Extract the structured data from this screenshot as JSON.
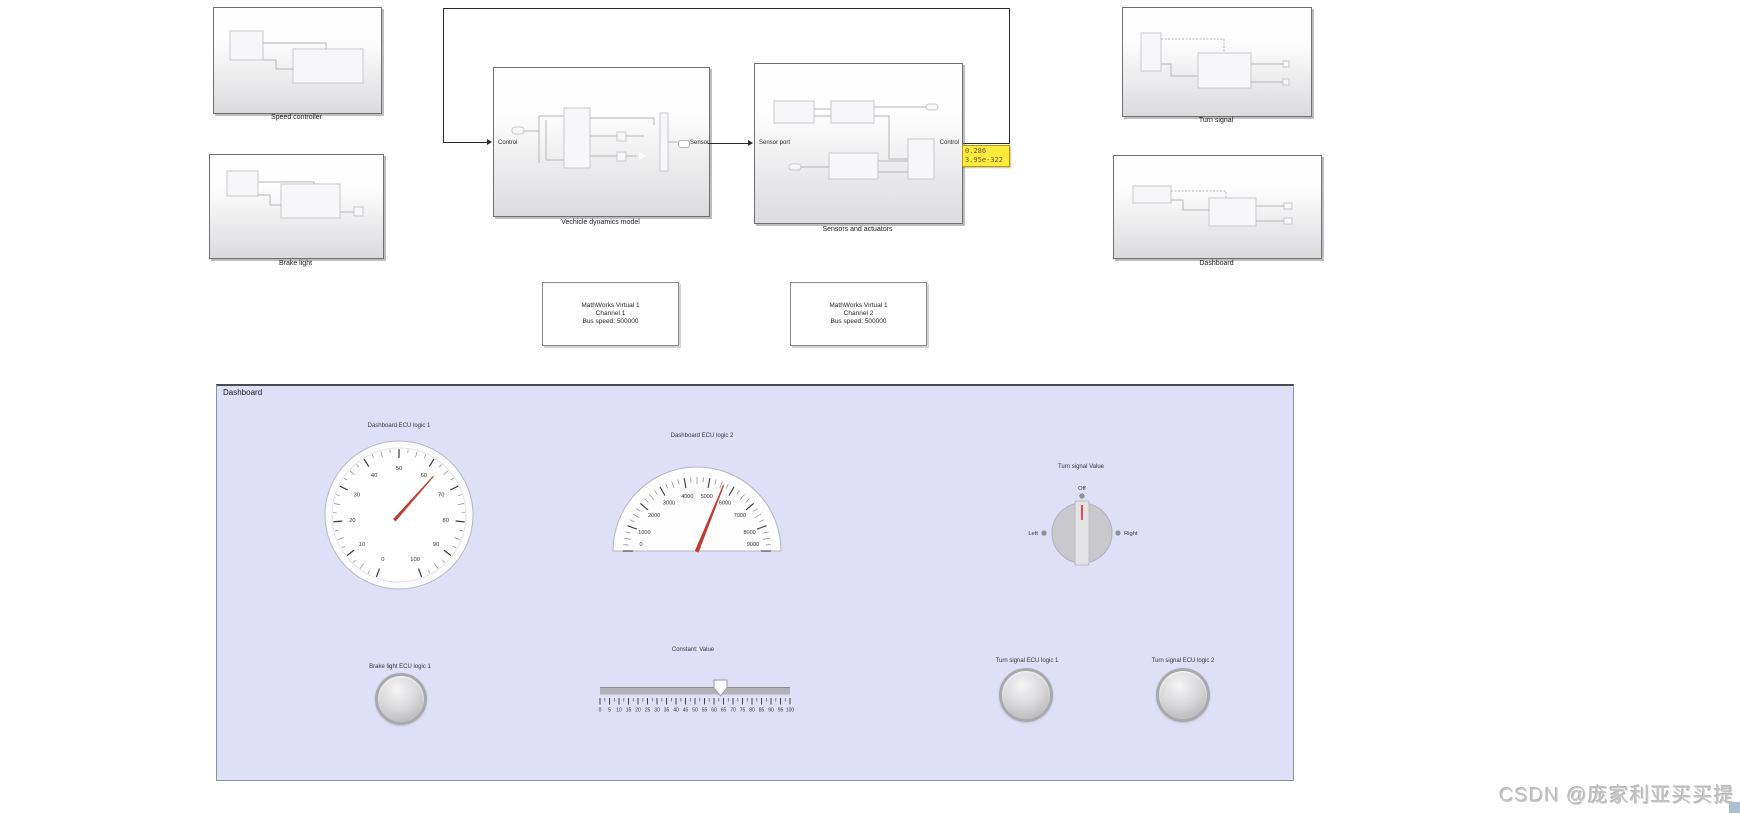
{
  "diagram": {
    "blocks": {
      "speed_controller": {
        "label": "Speed controller"
      },
      "brake_light": {
        "label": "Brake light"
      },
      "vehicle_dynamics": {
        "label": "Vechicle dynamics model",
        "port_in": "Control",
        "port_out": "Sensor"
      },
      "sensors_actuators": {
        "label": "Sensors and actuators",
        "port_in": "Sensor port",
        "port_out": "Control"
      },
      "turn_signal": {
        "label": "Turn signal"
      },
      "dashboard": {
        "label": "Dashboard"
      }
    },
    "can_blocks": [
      {
        "line1": "MathWorks Virtual 1",
        "line2": "Channel 1",
        "line3": "Bus speed: 500000"
      },
      {
        "line1": "MathWorks Virtual 1",
        "line2": "Channel 2",
        "line3": "Bus speed: 500000"
      }
    ],
    "port_value_tooltip": {
      "line1": "0.286",
      "line2": "3.95e-322"
    }
  },
  "panel": {
    "title": "Dashboard"
  },
  "chart_data": [
    {
      "type": "gauge",
      "variant": "circular",
      "title": "Dashboard ECU logic 1",
      "min": 0,
      "max": 100,
      "label_step": 10,
      "minor_step": 2.5,
      "value": 63,
      "start_angle": -160,
      "end_angle": 160,
      "needle_color": "#c23b2e",
      "tick_labels": [
        0,
        10,
        20,
        30,
        40,
        50,
        60,
        70,
        80,
        90,
        100
      ]
    },
    {
      "type": "gauge",
      "variant": "semicircular",
      "title": "Dashboard ECU logic 2",
      "min": 0,
      "max": 9000,
      "label_step": 1000,
      "minor_step": 250,
      "value": 5600,
      "start_angle": -90,
      "end_angle": 90,
      "needle_color": "#c23b2e",
      "tick_labels": [
        0,
        1000,
        2000,
        3000,
        4000,
        5000,
        6000,
        7000,
        8000,
        9000
      ]
    },
    {
      "type": "rotary-switch",
      "title": "Turn signal Value",
      "options": [
        "Left",
        "Off",
        "Right"
      ],
      "value": "Off",
      "pointer_color": "#e04b4b"
    },
    {
      "type": "slider",
      "title": "Constant: Value",
      "min": 0,
      "max": 100,
      "label_step": 5,
      "minor_step": 2.5,
      "value": 63.5,
      "tick_labels": [
        0,
        5,
        10,
        15,
        20,
        25,
        30,
        35,
        40,
        45,
        50,
        55,
        60,
        65,
        70,
        75,
        80,
        85,
        90,
        95,
        100
      ]
    },
    {
      "type": "lamp",
      "title": "Brake light ECU logic 1",
      "state": "off"
    },
    {
      "type": "lamp",
      "title": "Turn signal ECU logic 1",
      "state": "off"
    },
    {
      "type": "lamp",
      "title": "Turn signal ECU logic 2",
      "state": "off"
    }
  ],
  "watermark": {
    "text": "CSDN @庞家利亚买买提"
  }
}
